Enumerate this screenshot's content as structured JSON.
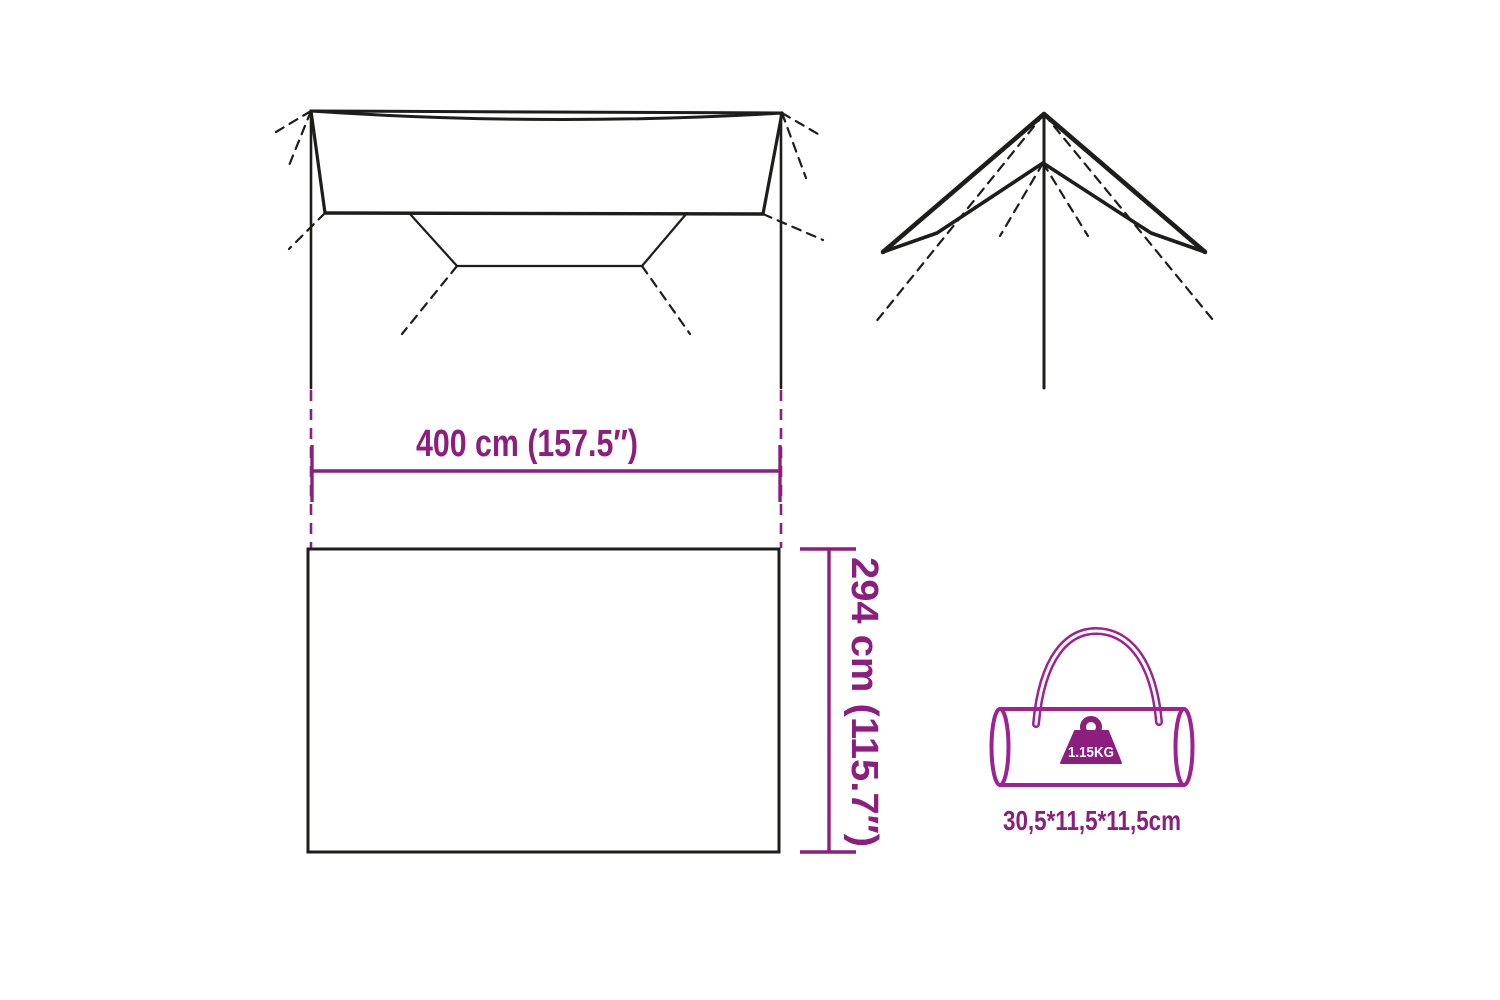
{
  "page": {
    "type": "product-dimension-diagram",
    "background": "#ffffff"
  },
  "colors": {
    "accent_purple": "#8C1E7D",
    "bag_outline_purple": "#9C2391",
    "line_black": "#1d1d1b",
    "weight_label_text": "#ffffff"
  },
  "dimensions": {
    "width_label": "400 cm (157.5″)",
    "height_label": "294 cm (115.7″)"
  },
  "bag": {
    "weight_label": "1.15KG",
    "size_label": "30,5*11,5*11,5cm"
  },
  "icons": {
    "tarp_top_view": "tarp-top-view-diagram",
    "tarp_pitched_view": "tarp-pitched-view-diagram",
    "carry_bag": "carry-bag-icon",
    "weight": "weight-icon"
  }
}
